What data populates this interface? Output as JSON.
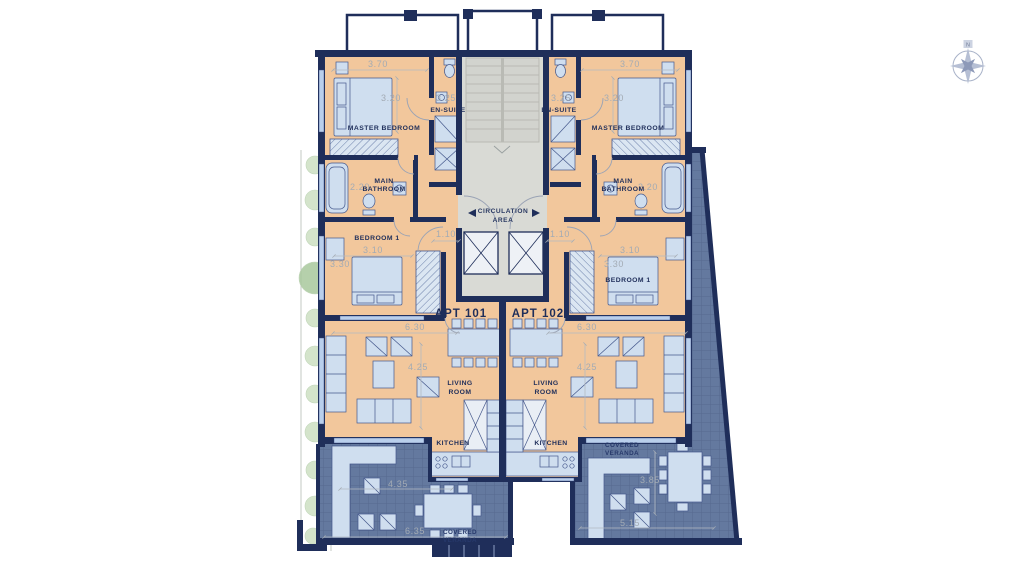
{
  "plan": {
    "compass": {
      "north": "N"
    },
    "circulation": {
      "line1": "CIRCULATION",
      "line2": "AREA",
      "dim_left": "1.10",
      "dim_right": "1.10"
    },
    "apartments": [
      {
        "name": "APT 101",
        "master_bedroom": {
          "label": "MASTER BEDROOM",
          "dim_w": "3.70",
          "dim_d": "3.20"
        },
        "en_suite": {
          "label": "EN-SUITE",
          "dim_w": "3.25"
        },
        "main_bathroom": {
          "line1": "MAIN",
          "line2": "BATHROOM",
          "dim_w": "2.20"
        },
        "bedroom_1": {
          "label": "BEDROOM 1",
          "dim_w": "3.10",
          "dim_d": "3.30"
        },
        "living_room": {
          "line1": "LIVING",
          "line2": "ROOM",
          "dim_w": "6.30",
          "dim_d": "4.25"
        },
        "kitchen": {
          "label": "KITCHEN"
        },
        "veranda": {
          "line1": "COVERED",
          "line2": "VERANDA",
          "dim_w": "6.35",
          "dim_d": "4.35"
        }
      },
      {
        "name": "APT 102",
        "master_bedroom": {
          "label": "MASTER BEDROOM",
          "dim_w": "3.70",
          "dim_d": "3.20"
        },
        "en_suite": {
          "label": "EN-SUITE",
          "dim_w": "3.25"
        },
        "main_bathroom": {
          "line1": "MAIN",
          "line2": "BATHROOM",
          "dim_w": "2.20"
        },
        "bedroom_1": {
          "label": "BEDROOM 1",
          "dim_w": "3.10",
          "dim_d": "3.30"
        },
        "living_room": {
          "line1": "LIVING",
          "line2": "ROOM",
          "dim_w": "6.30",
          "dim_d": "4.25"
        },
        "kitchen": {
          "label": "KITCHEN"
        },
        "veranda": {
          "line1": "COVERED",
          "line2": "VERANDA",
          "dim_w": "5.15",
          "dim_d": "3.85"
        }
      }
    ],
    "colors": {
      "wall": "#1f2e5a",
      "floor": "#f2c79c",
      "veranda": "#64799f",
      "fixture": "#cfdeef",
      "core": "#d9dad5",
      "dim_text": "#a3abb4",
      "plant": "#cde0c3"
    }
  }
}
